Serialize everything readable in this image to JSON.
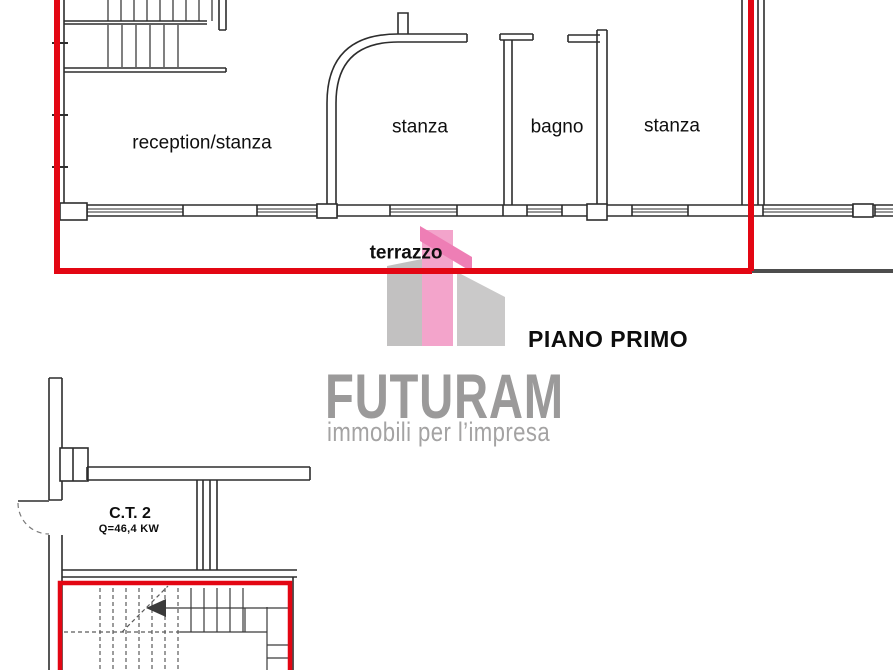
{
  "document": {
    "type": "floor-plan",
    "floor_title": "PIANO PRIMO"
  },
  "upper_plan": {
    "rooms": [
      {
        "label": "reception/stanza"
      },
      {
        "label": "stanza"
      },
      {
        "label": "bagno"
      },
      {
        "label": "stanza"
      }
    ],
    "terrace_label": "terrazzo"
  },
  "lower_plan": {
    "boiler_room_label": "C.T. 2",
    "boiler_power_label": "Q=46,4 KW"
  },
  "logo": {
    "brand": "FUTURAM",
    "tagline": "immobili per l’impresa"
  },
  "colors": {
    "outline_red": "#e30613",
    "wall_black": "#2d2d2d",
    "plan_gray_line": "#4d4d4d",
    "logo_pink_roof": "#ee7eb5",
    "logo_pink_bar": "#f3a4cb",
    "logo_gray_left": "#c2c1c1",
    "logo_gray_right": "#cac9c9",
    "logo_text_gray": "#9b9a9a"
  }
}
